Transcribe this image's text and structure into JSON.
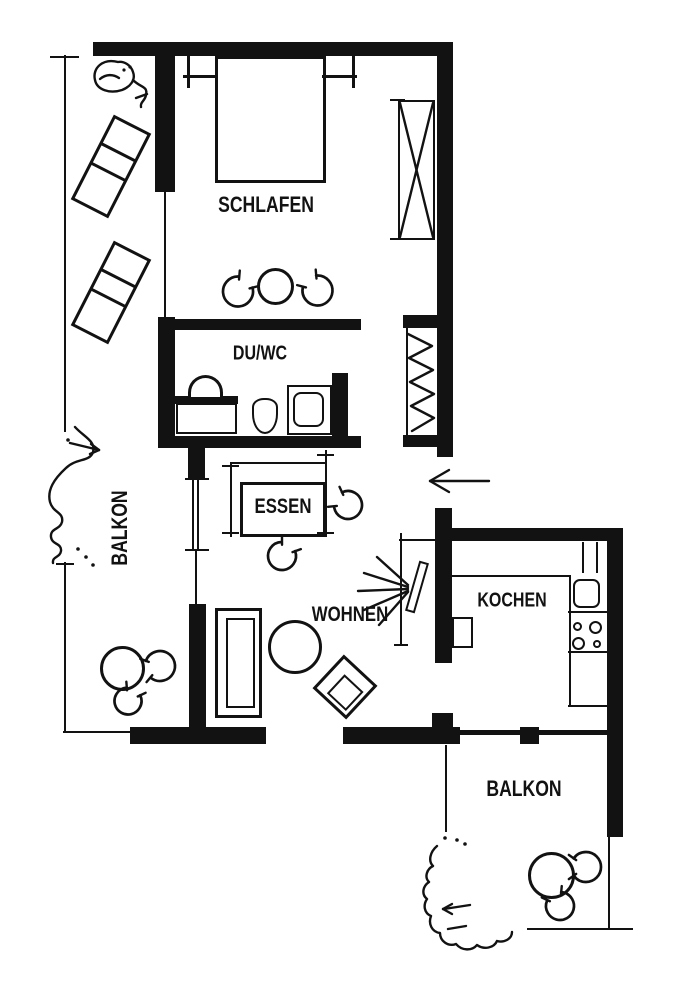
{
  "page": {
    "type": "apartment floor plan drawing",
    "paper_color": "#ffffff",
    "ink_color": "#121212"
  },
  "rooms": {
    "schlafen": {
      "label": "SCHLAFEN"
    },
    "du_wc": {
      "label": "DU/WC"
    },
    "essen": {
      "label": "ESSEN"
    },
    "wohnen": {
      "label": "WOHNEN"
    },
    "kochen": {
      "label": "KOCHEN"
    },
    "balkon_west": {
      "label": "BALKON"
    },
    "balkon_sued": {
      "label": "BALKON"
    }
  },
  "symbols": {
    "bed": "open rectangle with side tables",
    "wardrobe": "rectangle with X cross",
    "coat_rack": "zigzag hatching strip",
    "entrance": "arrow pointing left",
    "round_table": "circle",
    "chair": "three-quarter arc with end ticks",
    "dining_table": "rectangle with extension ticks",
    "sofa": "double rectangle",
    "armchair": "tilted double square",
    "tv": "tilted slab with radiating beam lines",
    "sideboard": "thin L line",
    "washbasin": "semicircle",
    "toilet": "oval bowl",
    "shower": "square with rounded pan",
    "kitchen_sink": "rounded square",
    "stove": "four burner circles",
    "small_appliance": "small square",
    "lounger": "tilted sectioned rectangle",
    "plant": "hand-drawn squiggle"
  }
}
